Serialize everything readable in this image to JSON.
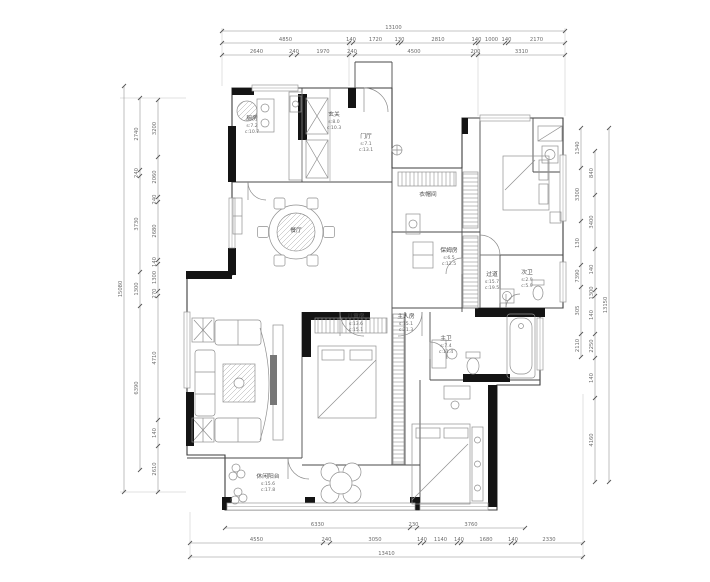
{
  "drawing": {
    "type": "residential-floor-plan",
    "units": "mm",
    "colors": {
      "background": "#ffffff",
      "thick_wall": "#141414",
      "thin_wall": "#3c3c3c",
      "furniture_line": "#8f8f8f",
      "dimension_text": "#6b6b6b"
    }
  },
  "dimensions": {
    "top": [
      {
        "orient": "h",
        "y": 31,
        "bounds": [
          222,
          565
        ],
        "labels": [
          "13100"
        ]
      },
      {
        "orient": "h",
        "y": 43,
        "bounds": [
          222,
          349,
          353,
          398,
          401,
          475,
          478,
          505,
          508,
          565
        ],
        "labels": [
          "4850",
          "140",
          "1720",
          "130",
          "2810",
          "140",
          "1000",
          "140",
          "2170"
        ]
      },
      {
        "orient": "h",
        "y": 55,
        "bounds": [
          222,
          291,
          297,
          349,
          355,
          473,
          478,
          565
        ],
        "labels": [
          "2640",
          "240",
          "1970",
          "240",
          "4500",
          "200",
          "3310"
        ]
      }
    ],
    "bottom": [
      {
        "orient": "h",
        "y": 528,
        "bounds": [
          225,
          410,
          417,
          525
        ],
        "labels": [
          "6330",
          "230",
          "3760"
        ]
      },
      {
        "orient": "h",
        "y": 543,
        "bounds": [
          190,
          323,
          330,
          420,
          424,
          457,
          461,
          511,
          515,
          583
        ],
        "labels": [
          "4550",
          "240",
          "3050",
          "140",
          "1140",
          "140",
          "1680",
          "140",
          "2330"
        ]
      },
      {
        "orient": "h",
        "y": 557,
        "bounds": [
          190,
          583
        ],
        "labels": [
          "13410"
        ]
      }
    ],
    "left": [
      {
        "orient": "v",
        "x": 124,
        "bounds": [
          86,
          492
        ],
        "labels": [
          "15080"
        ]
      },
      {
        "orient": "v",
        "x": 140,
        "bounds": [
          98,
          170,
          176,
          272,
          306,
          470
        ],
        "labels": [
          "2740",
          "240",
          "3730",
          "1300",
          "6390"
        ]
      },
      {
        "orient": "v",
        "x": 158,
        "bounds": [
          100,
          157,
          197,
          202,
          260,
          264,
          291,
          296,
          420,
          446,
          492
        ],
        "labels": [
          "3200",
          "2060",
          "240",
          "2680",
          "140",
          "1300",
          "270",
          "4710",
          "140",
          "2610"
        ]
      }
    ],
    "right": [
      {
        "orient": "v",
        "x": 581,
        "bounds": [
          128,
          168,
          221,
          265,
          287,
          334,
          357
        ],
        "labels": [
          "1340",
          "3300",
          "130",
          "7390",
          "305",
          "2110"
        ]
      },
      {
        "orient": "v",
        "x": 595,
        "bounds": [
          151,
          195,
          249,
          290,
          296,
          334,
          358,
          398,
          482
        ],
        "labels": [
          "840",
          "3400",
          "140",
          "1300",
          "140",
          "2250",
          "140",
          "4160"
        ]
      },
      {
        "orient": "v",
        "x": 609,
        "bounds": [
          128,
          482
        ],
        "labels": [
          "13150"
        ]
      }
    ]
  },
  "rooms": [
    {
      "name": "厨房",
      "area_s": "s:7.2",
      "area_c": "c:10.7",
      "x": 252,
      "y": 120
    },
    {
      "name": "玄关",
      "area_s": "s:8.0",
      "area_c": "c:10.3",
      "x": 334,
      "y": 116
    },
    {
      "name": "门厅",
      "area_s": "s:7.1",
      "area_c": "c:13.1",
      "x": 366,
      "y": 138
    },
    {
      "name": "衣帽间",
      "area_s": "",
      "area_c": "",
      "x": 428,
      "y": 196
    },
    {
      "name": "保姆房",
      "area_s": "s:6.5",
      "area_c": "c:12.5",
      "x": 449,
      "y": 252
    },
    {
      "name": "过道",
      "area_s": "s:15.7",
      "area_c": "c:19.5",
      "x": 492,
      "y": 276
    },
    {
      "name": "次卫",
      "area_s": "s:2.9",
      "area_c": "c:5.9",
      "x": 527,
      "y": 274
    },
    {
      "name": "餐厅",
      "area_s": "",
      "area_c": "",
      "x": 296,
      "y": 232
    },
    {
      "name": "儿童房",
      "area_s": "s:13.6",
      "area_c": "c:15.1",
      "x": 356,
      "y": 318
    },
    {
      "name": "主人房",
      "area_s": "s:15.1",
      "area_c": "c:21.3",
      "x": 406,
      "y": 318
    },
    {
      "name": "主卫",
      "area_s": "s:7.4",
      "area_c": "c:11.4",
      "x": 446,
      "y": 340
    },
    {
      "name": "休闲阳台",
      "area_s": "s:15.6",
      "area_c": "c:17.8",
      "x": 268,
      "y": 478
    }
  ]
}
